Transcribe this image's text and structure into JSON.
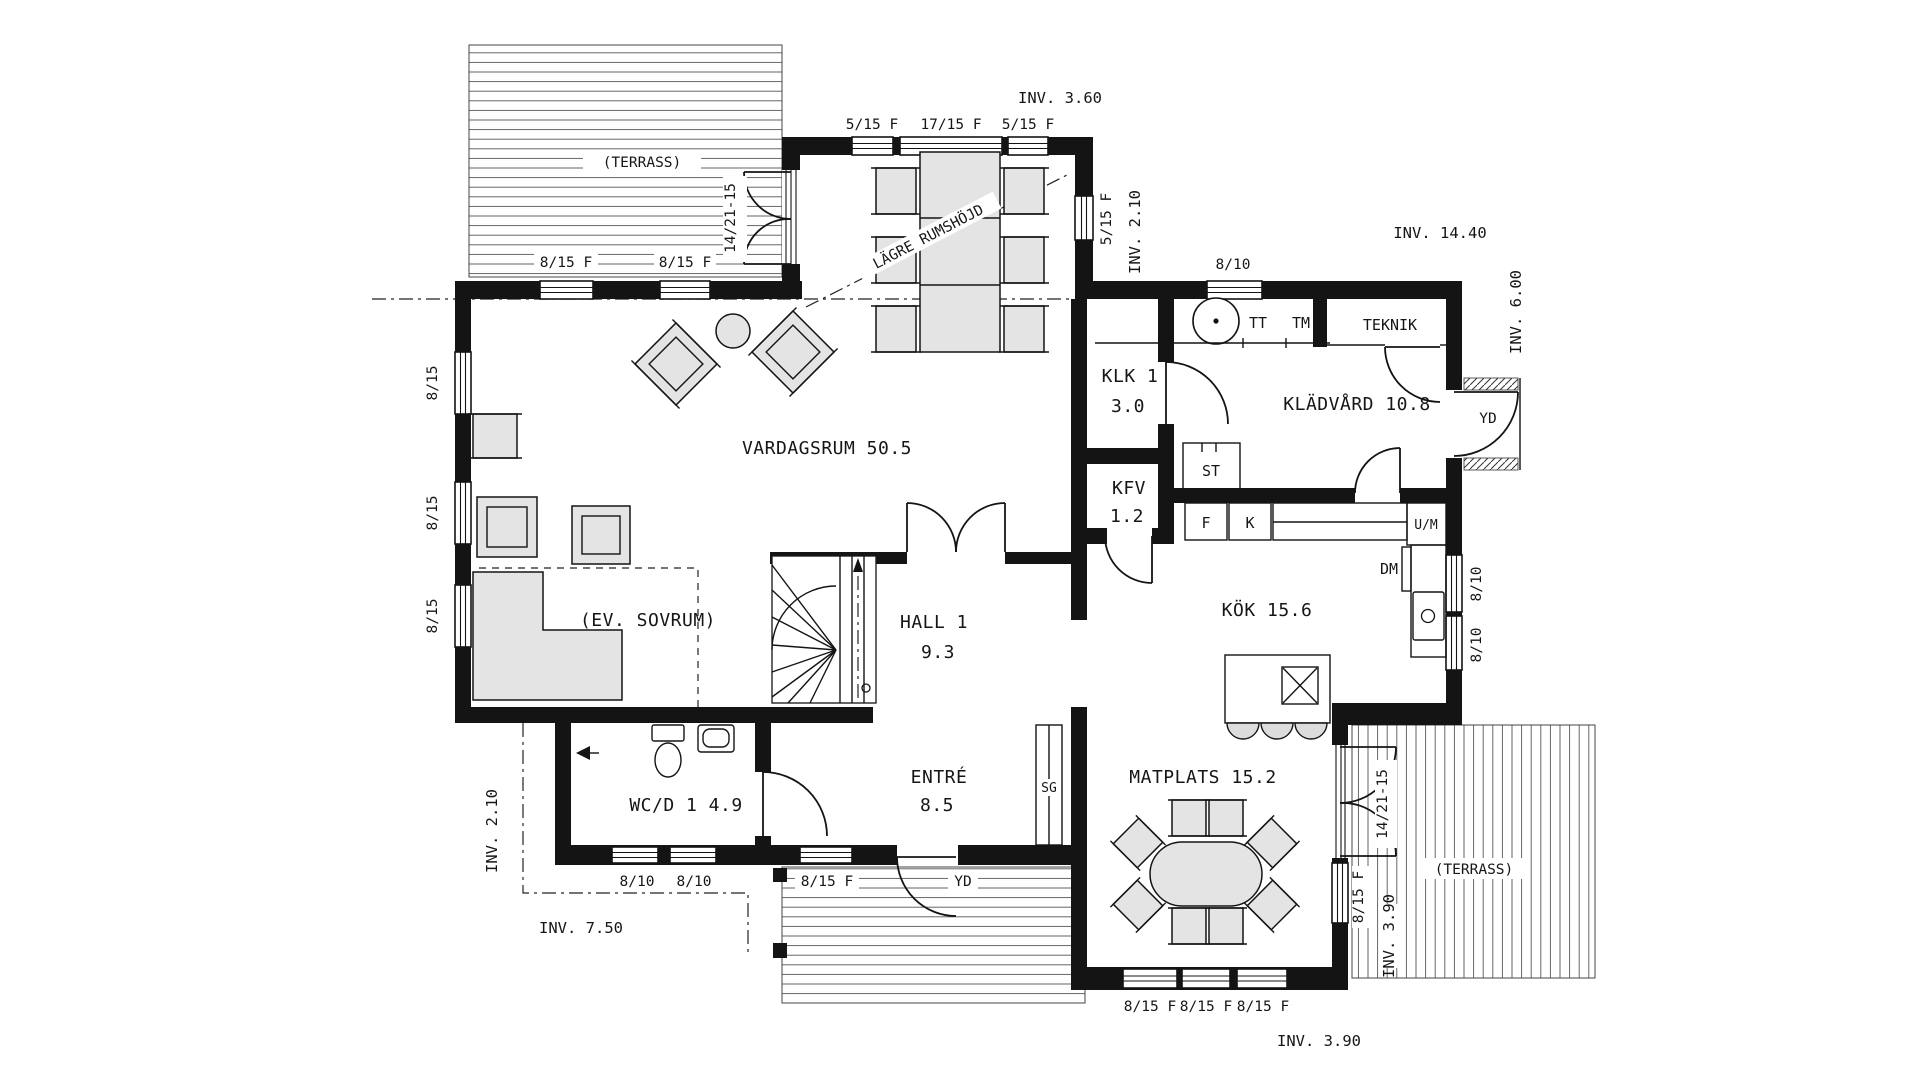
{
  "plan": {
    "rooms": {
      "vardagsrum": "VARDAGSRUM 50.5",
      "ev_sovrum": "(EV. SOVRUM)",
      "hall": "HALL 1",
      "hall_area": "9.3",
      "entre": "ENTRÉ",
      "entre_area": "8.5",
      "wcd": "WC/D 1 4.9",
      "klk": "KLK 1",
      "klk_area": "3.0",
      "kfv": "KFV",
      "kfv_area": "1.2",
      "kladvard": "KLÄDVÅRD 10.8",
      "teknik": "TEKNIK",
      "kok": "KÖK 15.6",
      "matplats": "MATPLATS 15.2",
      "terrass_top": "(TERRASS)",
      "terrass_right": "(TERRASS)"
    },
    "annotations": {
      "lagre_rumshojd": "LÄGRE RUMSHÖJD"
    },
    "dimensions": {
      "inv_360": "INV. 3.60",
      "inv_210_top": "INV. 2.10",
      "inv_1440": "INV. 14.40",
      "inv_600": "INV. 6.00",
      "inv_210_left": "INV. 2.10",
      "inv_750": "INV. 7.50",
      "inv_390_right": "INV. 3.90",
      "inv_390_bottom": "INV. 3.90"
    },
    "openings": {
      "popout_top_1": "5/15 F",
      "popout_top_2": "17/15 F",
      "popout_top_3": "5/15 F",
      "popout_right": "5/15 F",
      "top_left_1": "8/15 F",
      "top_left_2": "8/15 F",
      "top_right": "8/10",
      "left_1": "8/15",
      "left_2": "8/15",
      "left_3": "8/15",
      "kok_right_1": "8/10",
      "kok_right_2": "8/10",
      "matplats_right": "8/15 F",
      "bottom_matplats_1": "8/15 F",
      "bottom_matplats_2": "8/15 F",
      "bottom_matplats_3": "8/15 F",
      "bottom_wc_1": "8/10",
      "bottom_wc_2": "8/10",
      "bottom_entre": "8/15 F",
      "door_top": "14/21-15",
      "door_matplats": "14/21-15",
      "door_yd_right": "YD",
      "door_yd_entry": "YD"
    },
    "fixtures": {
      "tt": "TT",
      "tm": "TM",
      "st": "ST",
      "f": "F",
      "k": "K",
      "um": "U/M",
      "dm": "DM",
      "sg": "SG"
    }
  }
}
